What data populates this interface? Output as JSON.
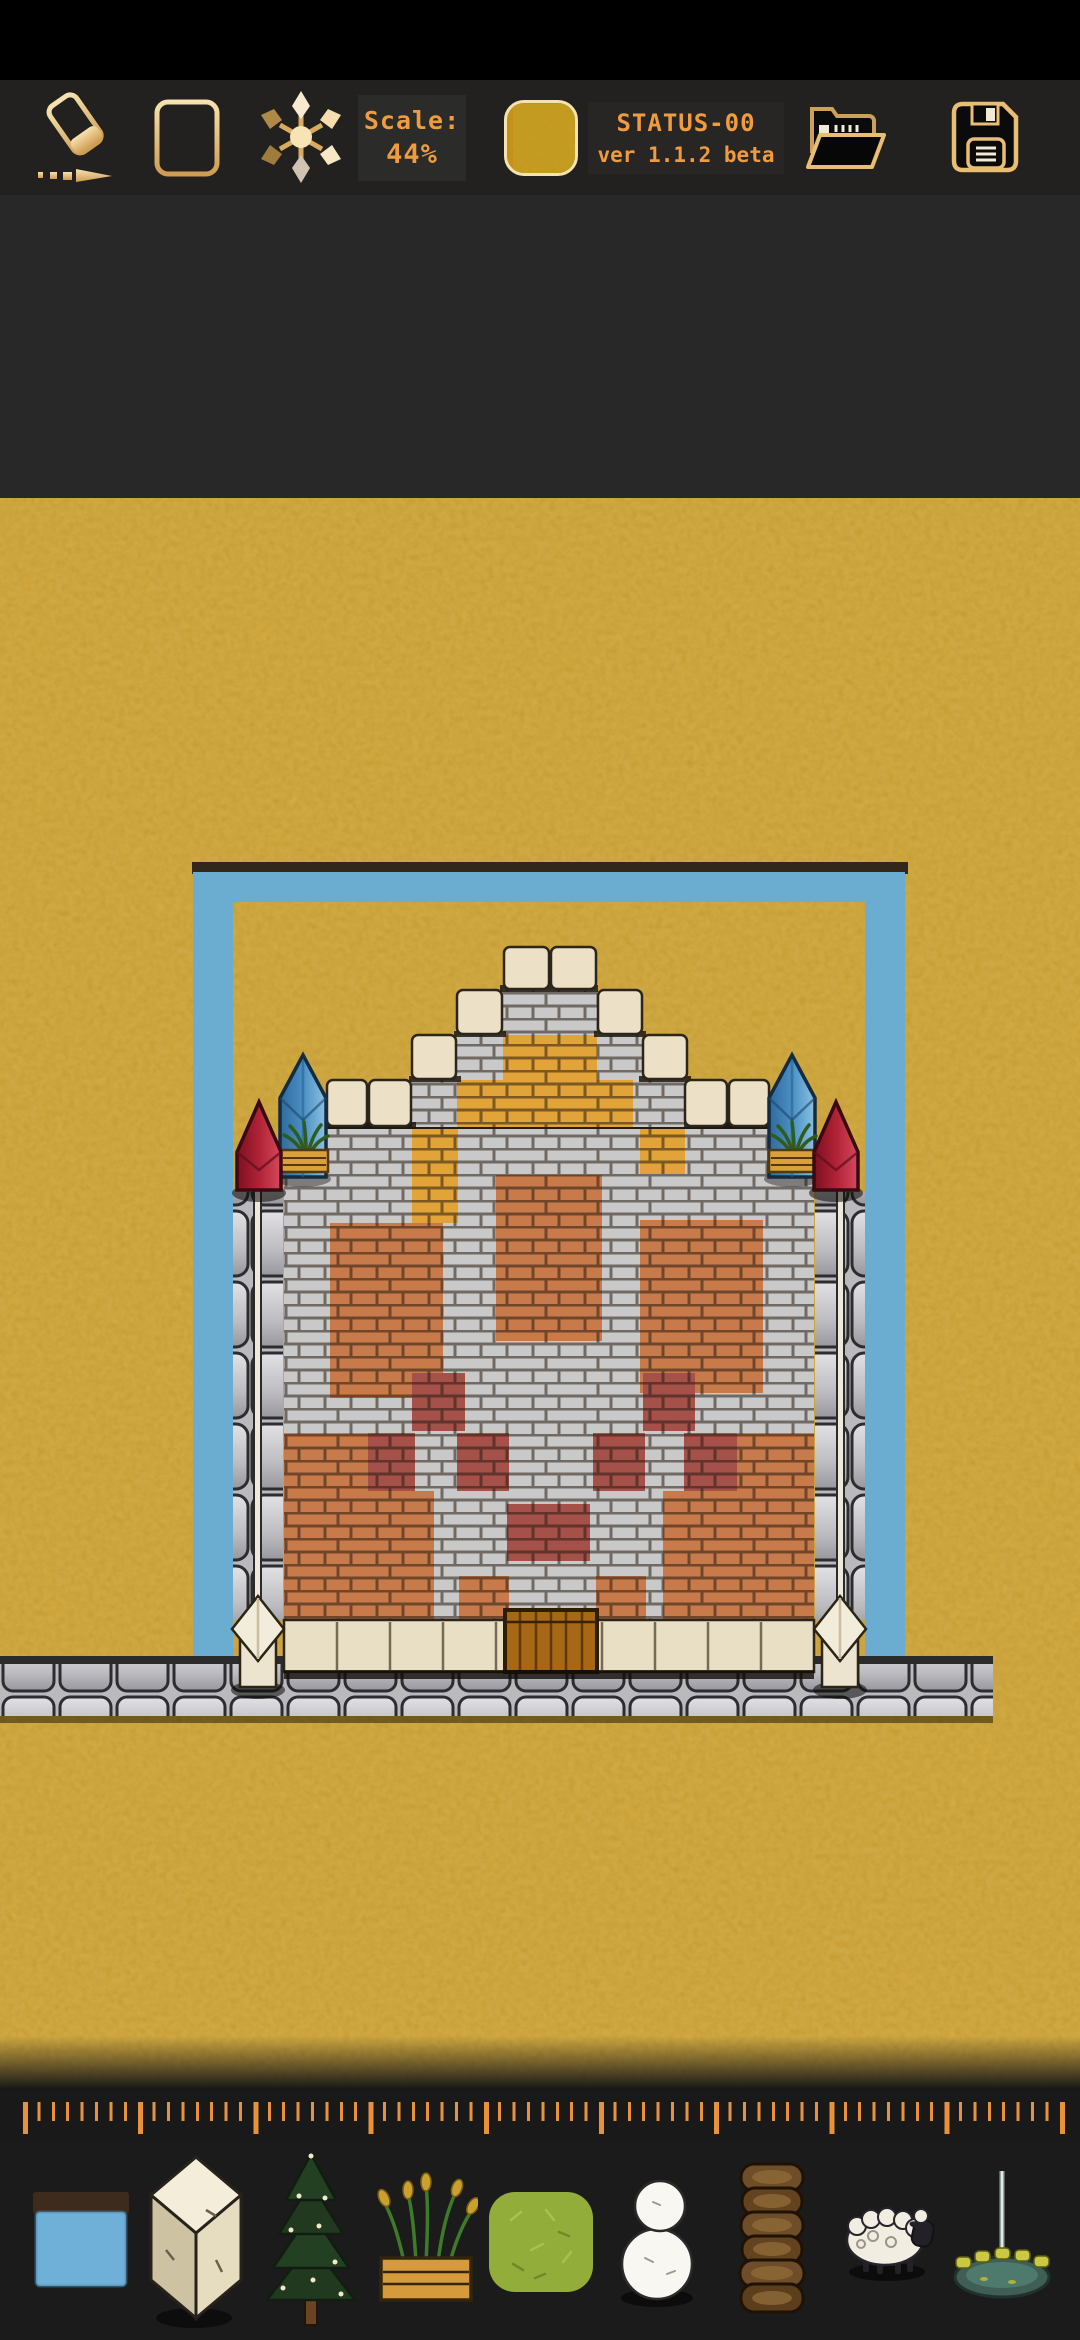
{
  "toolbar": {
    "eraser_icon": "eraser-tool",
    "grid_icon": "grid-toggle",
    "scatter_icon": "scatter-brush-tool",
    "scale_label": "Scale:",
    "scale_value": "44%",
    "current_tile_icon": "sand-ground-tile-preview",
    "status_line_1": "STATUS-00",
    "status_line_2": "ver 1.1.2 beta",
    "open_icon": "open-folder",
    "save_icon": "save-floppy"
  },
  "canvas": {
    "scale_percent": 44,
    "scene": "isometric brick castle with stepped parapet inside a blue square moat frame on sandy ground, cobblestone road along the bottom"
  },
  "colors": {
    "accent_orange": "#e8923c",
    "text_orange": "#ef9c40",
    "icon_gold_light": "#f6e2ae",
    "icon_gold_dark": "#cf9c52",
    "toolbar_bg": "#222120",
    "panel_bg": "#2b2b29",
    "dock_bg": "#1b1b1b",
    "ground_gold": "#d2a02b",
    "frame_blue": "#6badd0",
    "frame_edge_dark": "#33261a",
    "stone_gray": "#c9c9c9",
    "brick_orange": "#c87a4a",
    "brick_dark_red": "#a5514a",
    "brick_gold": "#e2a438",
    "block_cream": "#ece1c6",
    "crystal_blue": "#4a8fc4",
    "crystal_red": "#b02236",
    "door_wood": "#a66716",
    "road_gray": "#b9b9be",
    "planter_wood": "#d9a03c",
    "grass_green": "#93ad3b"
  },
  "palette": {
    "items": [
      {
        "icon": "water-tile"
      },
      {
        "icon": "stone-pillar-block"
      },
      {
        "icon": "pine-tree"
      },
      {
        "icon": "flower-planter"
      },
      {
        "icon": "grass-tile"
      },
      {
        "icon": "snowman"
      },
      {
        "icon": "log-stack"
      },
      {
        "icon": "sheep"
      },
      {
        "icon": "fountain"
      }
    ]
  }
}
